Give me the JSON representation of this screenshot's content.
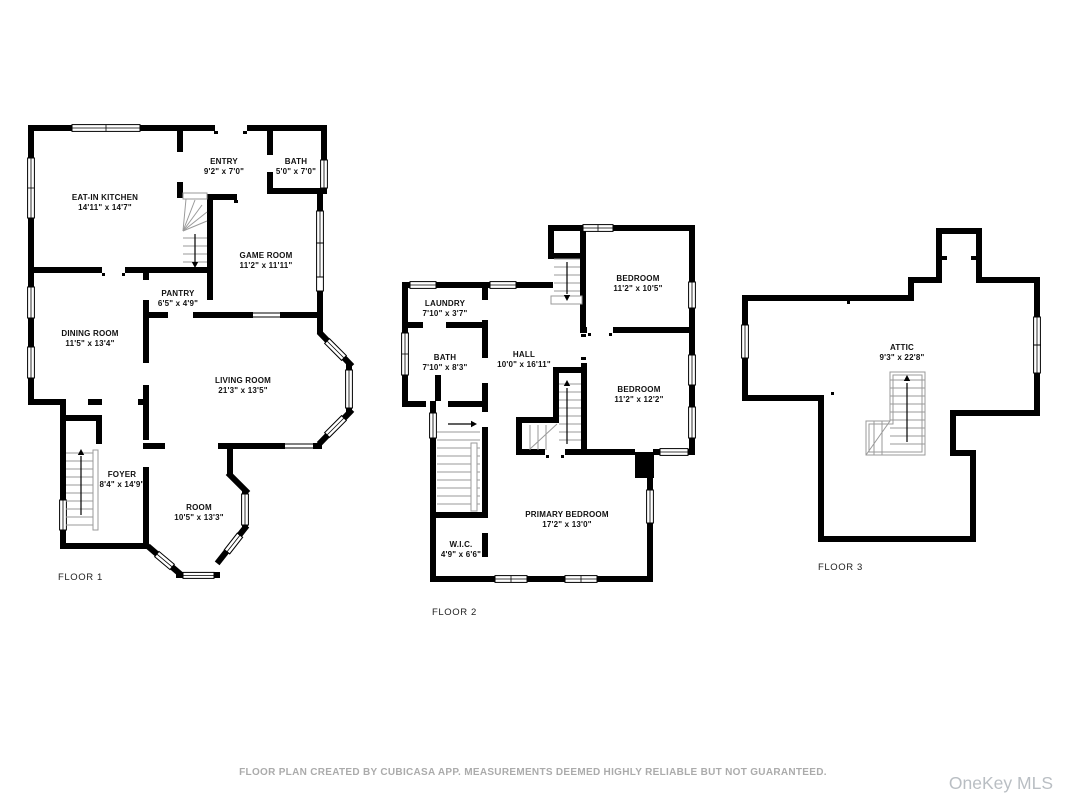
{
  "page": {
    "background": "#ffffff"
  },
  "colors": {
    "wall": "#000000",
    "stair_lines": "#9a9a9a",
    "room_label": "#111111",
    "floor_label": "#222222",
    "footer_text": "#ababab",
    "watermark_text": "#b9bec3"
  },
  "footer": {
    "disclaimer": "FLOOR PLAN CREATED BY CUBICASA APP. MEASUREMENTS DEEMED HIGHLY RELIABLE BUT NOT GUARANTEED.",
    "watermark": "OneKey MLS"
  },
  "floors": [
    {
      "label": "FLOOR 1",
      "rooms": [
        {
          "name": "EAT-IN KITCHEN",
          "dims": "14'11\" x 14'7\""
        },
        {
          "name": "ENTRY",
          "dims": "9'2\" x 7'0\""
        },
        {
          "name": "BATH",
          "dims": "5'0\" x 7'0\""
        },
        {
          "name": "GAME ROOM",
          "dims": "11'2\" x 11'11\""
        },
        {
          "name": "PANTRY",
          "dims": "6'5\" x 4'9\""
        },
        {
          "name": "DINING ROOM",
          "dims": "11'5\" x 13'4\""
        },
        {
          "name": "LIVING ROOM",
          "dims": "21'3\" x 13'5\""
        },
        {
          "name": "FOYER",
          "dims": "8'4\" x 14'9\""
        },
        {
          "name": "ROOM",
          "dims": "10'5\" x 13'3\""
        }
      ]
    },
    {
      "label": "FLOOR 2",
      "rooms": [
        {
          "name": "LAUNDRY",
          "dims": "7'10\" x 3'7\""
        },
        {
          "name": "BEDROOM",
          "dims": "11'2\" x 10'5\""
        },
        {
          "name": "BATH",
          "dims": "7'10\" x 8'3\""
        },
        {
          "name": "HALL",
          "dims": "10'0\" x 16'11\""
        },
        {
          "name": "BEDROOM",
          "dims": "11'2\" x 12'2\""
        },
        {
          "name": "PRIMARY BEDROOM",
          "dims": "17'2\" x 13'0\""
        },
        {
          "name": "W.I.C.",
          "dims": "4'9\" x 6'6\""
        }
      ]
    },
    {
      "label": "FLOOR 3",
      "rooms": [
        {
          "name": "ATTIC",
          "dims": "9'3\" x 22'8\""
        }
      ]
    }
  ]
}
